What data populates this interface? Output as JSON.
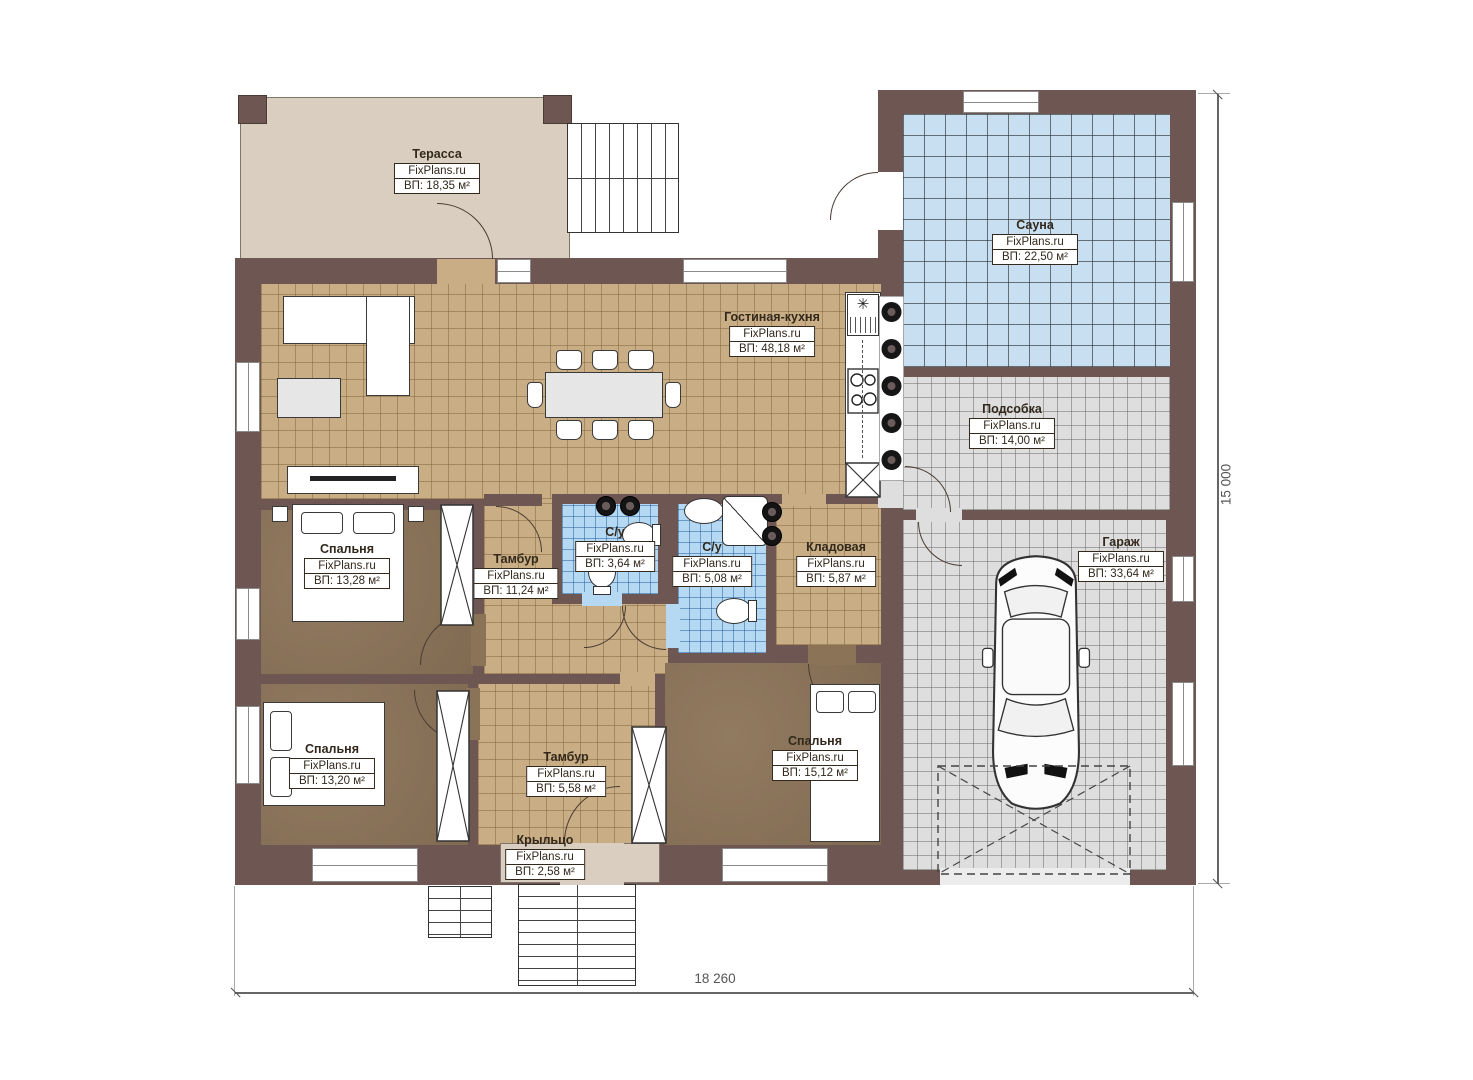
{
  "brand": "FixPlans.ru",
  "rooms": [
    {
      "id": "terrace",
      "name": "Терасса",
      "area": "ВП: 18,35 м²"
    },
    {
      "id": "sauna",
      "name": "Сауна",
      "area": "ВП: 22,50 м²"
    },
    {
      "id": "living-kitchen",
      "name": "Гостиная-кухня",
      "area": "ВП: 48,18 м²"
    },
    {
      "id": "utility",
      "name": "Подсобка",
      "area": "ВП: 14,00 м²"
    },
    {
      "id": "bedroom-1",
      "name": "Спальня",
      "area": "ВП: 13,28 м²"
    },
    {
      "id": "tambour-1",
      "name": "Тамбур",
      "area": "ВП: 11,24 м²"
    },
    {
      "id": "wc-1",
      "name": "С/у",
      "area": "ВП: 3,64 м²"
    },
    {
      "id": "wc-2",
      "name": "С/у",
      "area": "ВП: 5,08 м²"
    },
    {
      "id": "storage",
      "name": "Кладовая",
      "area": "ВП: 5,87 м²"
    },
    {
      "id": "garage",
      "name": "Гараж",
      "area": "ВП: 33,64 м²"
    },
    {
      "id": "bedroom-2",
      "name": "Спальня",
      "area": "ВП: 13,20 м²"
    },
    {
      "id": "tambour-2",
      "name": "Тамбур",
      "area": "ВП: 5,58 м²"
    },
    {
      "id": "bedroom-3",
      "name": "Спальня",
      "area": "ВП: 15,12 м²"
    },
    {
      "id": "porch",
      "name": "Крыльцо",
      "area": "ВП: 2,58 м²"
    }
  ],
  "dimensions": {
    "width_mm": "18 260",
    "height_mm": "15 000"
  },
  "colors": {
    "wall": "#6e5752",
    "terrace_floor": "#d9cec0",
    "living_floor": "#c9ae85",
    "bedroom_floor": "#8b7358",
    "bathroom_floor": "#b5d8f3",
    "sauna_floor": "#c8dff2",
    "garage_floor": "#dedede",
    "label_border": "#32281c"
  }
}
